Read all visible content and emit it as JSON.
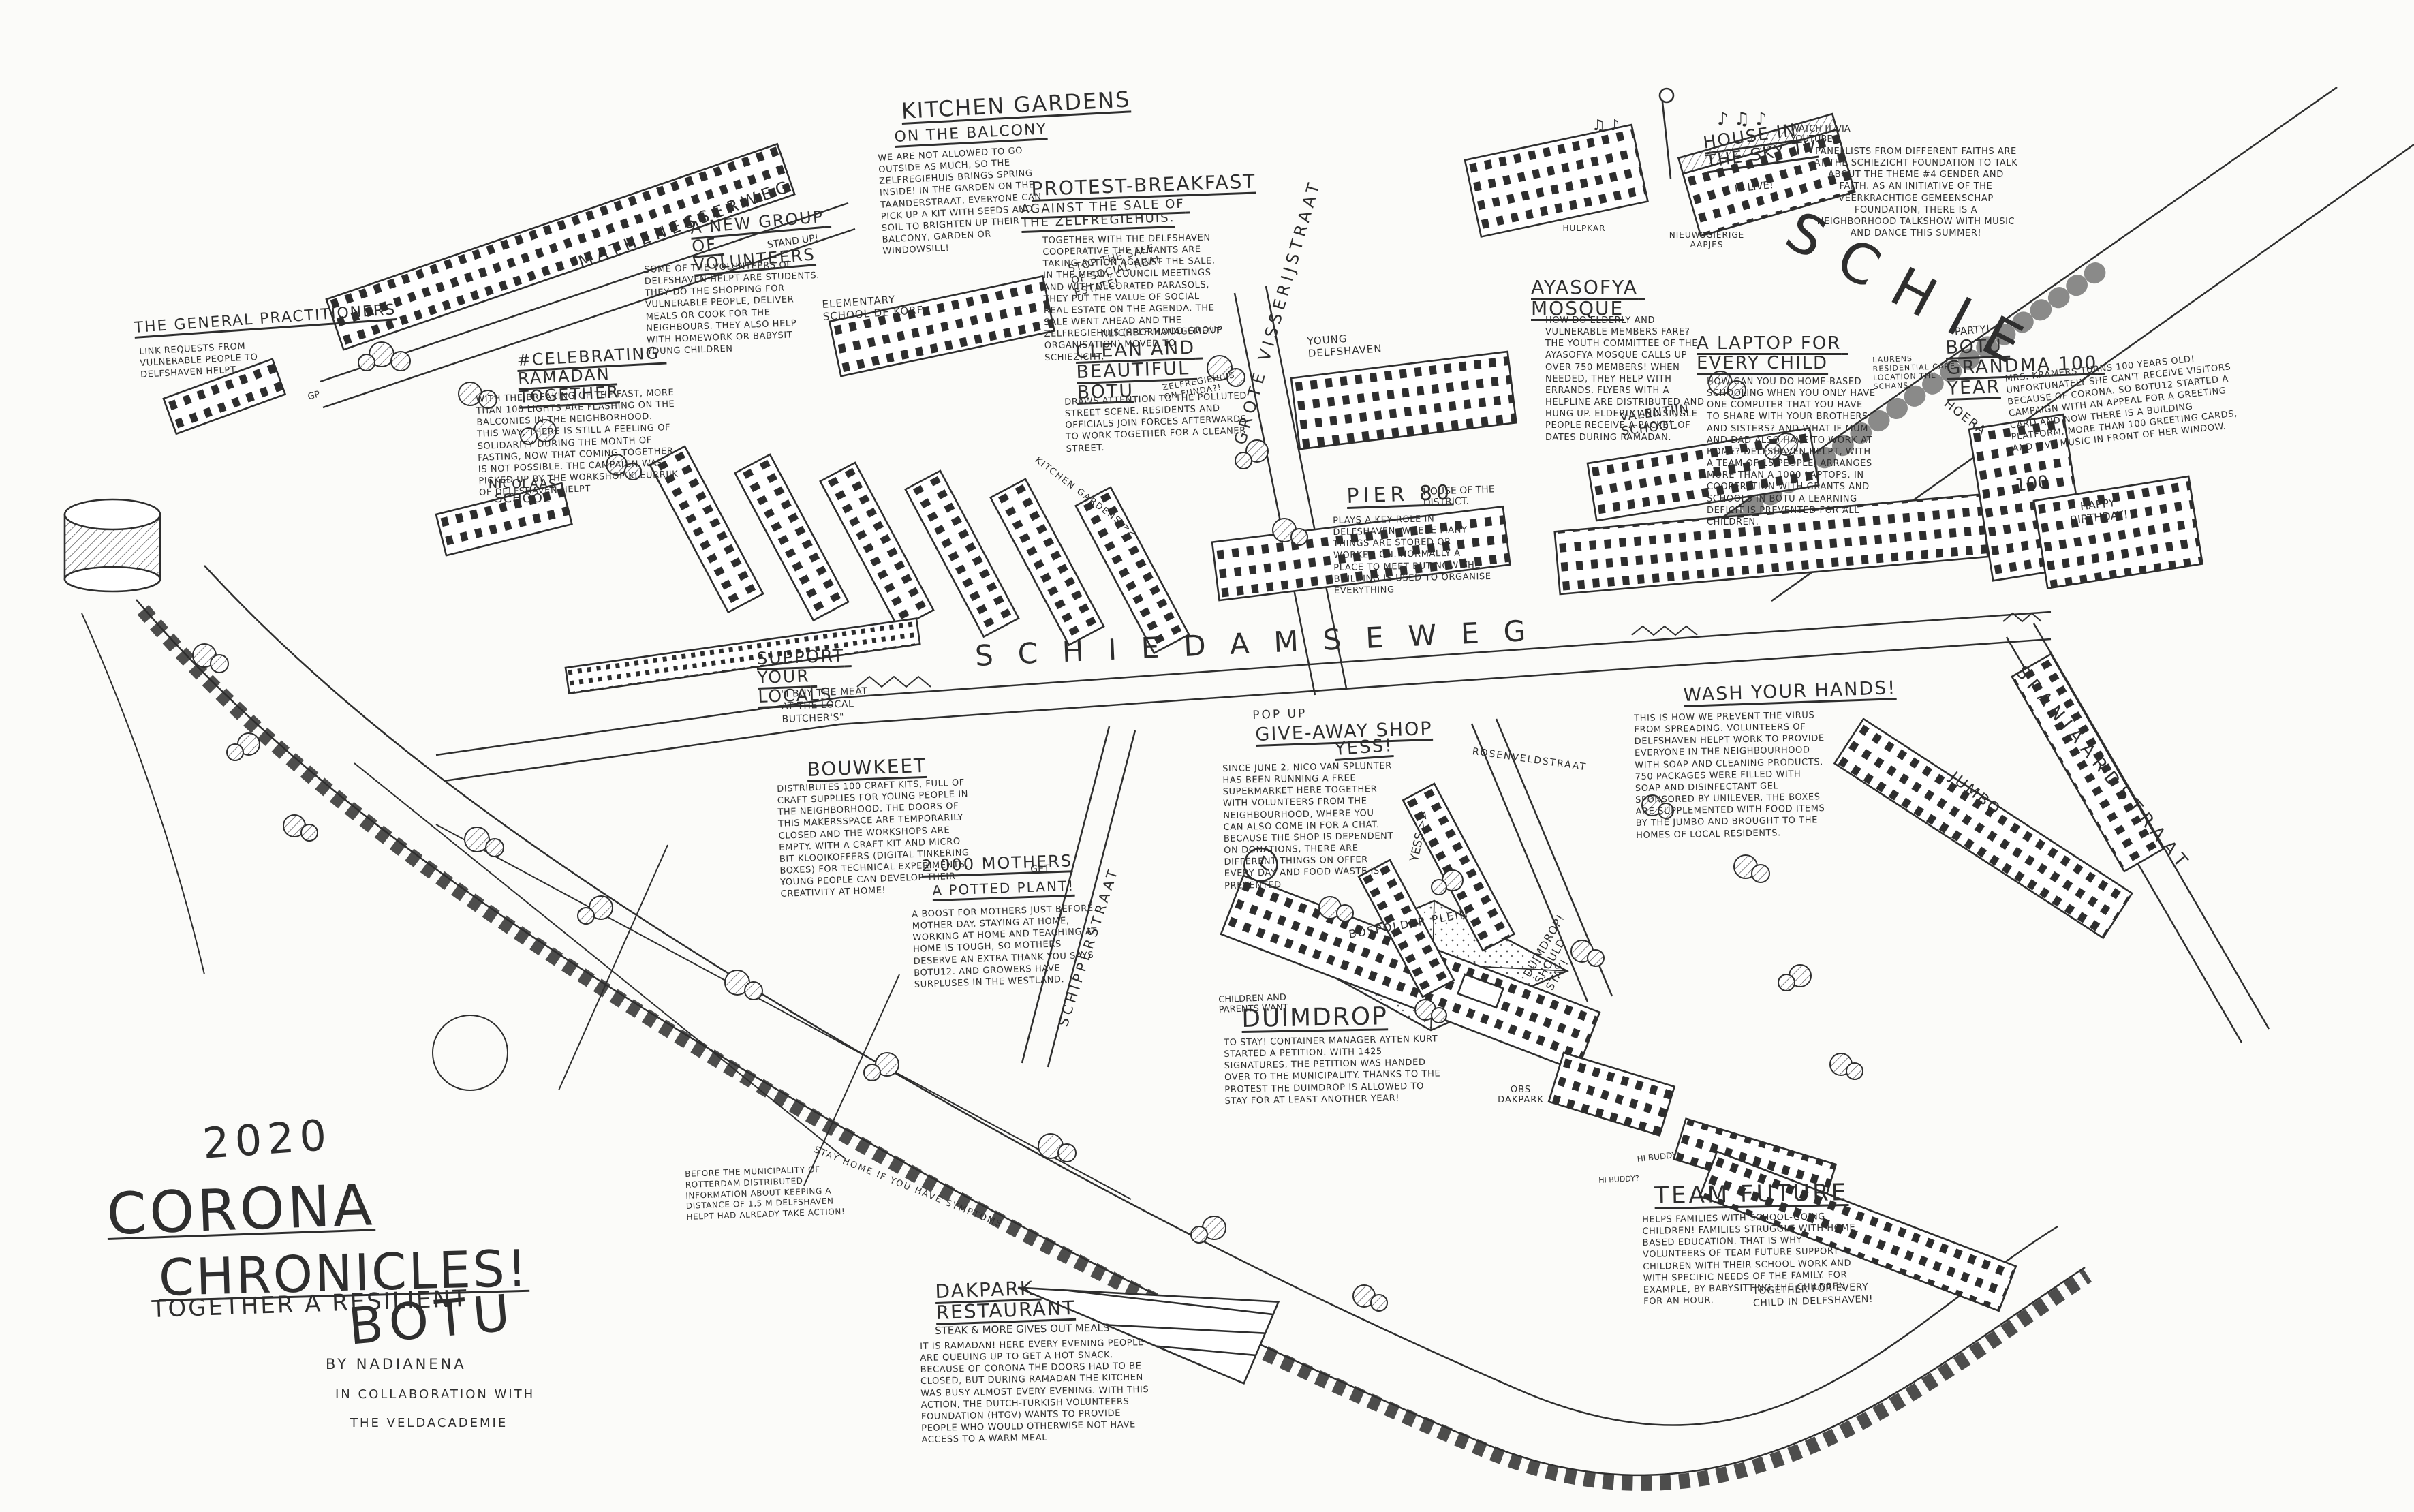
{
  "artwork": {
    "year": "2020",
    "title1": "CORONA",
    "title2": "CHRONICLES!",
    "subtitle": "TOGETHER A RESILIENT",
    "name": "BOTU",
    "credit_by": "BY NADIANENA",
    "credit_collab1": "IN COLLABORATION WITH",
    "credit_collab2": "THE VELDACADEMIE"
  },
  "streets": {
    "mathenesserweg": "MATHENESSERWEG",
    "schiedamseweg": "SCHIEDAMSEWEG",
    "grote_visserijstraat": "GROTE VISSERIJSTRAAT",
    "schipperstraat": "SCHIPPERSTRAAT",
    "spanjaardstraat": "SPANJAARDSTRAAT",
    "rosenveldstraat": "ROSENVELDSTRAAT",
    "schie": "SCHIE",
    "bospolderplein": "BOSPOLDER PLEIN"
  },
  "places": {
    "nicolaas_school": "NICOLAAS SCHOOL",
    "de_korf": "ELEMENTARY SCHOOL DE KORF",
    "valentijn_school": "VALENTIJN SCHOOL",
    "young_delfshaven": "YOUNG DELFSHAVEN",
    "laurens": "LAURENS RESIDENTIAL CARE LOCATION THE SCHANS.",
    "obs_dakpark": "OBS DAKPARK",
    "jumbo": "JUMBO",
    "gp": "GP",
    "nieuwsgierige_aapjes": "NIEUWSGIERIGE AAPJES",
    "hulpkar": "HULPKAR"
  },
  "signs": {
    "stop_sale": "STOP THE SALE OF SOCIAL REAL ESTATE!",
    "funda": "ZELFREGIEHUIS ON FUNDA?!",
    "kitchen_gardens_arrow": "KITCHEN GARDENS >>",
    "yess_arrow": "YESS >>",
    "duimdrop_should_stay": "DUIMDROP! SHOULD STAY!",
    "stay_home": "STAY HOME IF YOU HAVE SYMPTOMS",
    "happy_birthday": "HAPPY BIRTHDAY!",
    "hoera": "HOERA",
    "hundred": "100",
    "hi_buddy_1": "HI BUDDY!",
    "hi_buddy_2": "HI BUDDY?",
    "music_1": "♪ ♫  ♪",
    "music_2": "♫ ♪"
  },
  "stories": {
    "kitchen_gardens": {
      "title": "KITCHEN GARDENS",
      "subtitle": "ON THE BALCONY",
      "body": "WE ARE NOT ALLOWED TO GO OUTSIDE AS MUCH, SO THE ZELFREGIEHUIS BRINGS SPRING INSIDE! IN THE GARDEN ON THE TAANDERSTRAAT, EVERYONE CAN PICK UP A KIT WITH SEEDS AND SOIL TO BRIGHTEN UP THEIR BALCONY, GARDEN OR WINDOWSILL!"
    },
    "protest_breakfast": {
      "title": "PROTEST-BREAKFAST",
      "subtitle": "AGAINST THE SALE OF THE ZELFREGIEHUIS.",
      "body": "TOGETHER WITH THE DELFSHAVEN COOPERATIVE THE TENANTS ARE TAKING ACTION AGAINST THE SALE. IN THE MEDIA, COUNCIL MEETINGS AND WITH DECORATED PARASOLS, THEY PUT THE VALUE OF SOCIAL REAL ESTATE ON THE AGENDA. THE SALE WENT AHEAD AND THE ZELFREGIEHUIS (SELF MANAGEMENT ORGANISATION) MOVED TO SCHIEZICHT."
    },
    "new_volunteers": {
      "title": "A NEW GROUP OF VOLUNTEERS",
      "note": "STAND UP!",
      "body": "SOME OF THE VOLUNTEERS OF DELFSHAVEN HELPT ARE STUDENTS. THEY DO THE SHOPPING FOR VULNERABLE PEOPLE, DELIVER MEALS OR COOK FOR THE NEIGHBOURS. THEY ALSO HELP WITH HOMEWORK OR BABYSIT YOUNG CHILDREN"
    },
    "general_practitioners": {
      "title": "THE GENERAL PRACTITIONERS",
      "body": "LINK REQUESTS FROM VULNERABLE PEOPLE TO DELFSHAVEN HELPT"
    },
    "ramadan": {
      "title": "#CELEBRATING RAMADAN TOGETHER",
      "body": "WITH THE BREAKING OF THE FAST, MORE THAN 100 LIGHTS ARE FLASHING ON THE BALCONIES IN THE NEIGHBORHOOD. THIS WAY, THERE IS STILL A FEELING OF SOLIDARITY DURING THE MONTH OF FASTING, NOW THAT COMING TOGETHER IS NOT POSSIBLE. THE CAMPAIGN WAS PICKED UP BY THE WORKSHOP KLEURRIJK OF DELFSHAVEN HELPT"
    },
    "clean_beautiful": {
      "kicker": "NEIGHBORHOOD GROUP",
      "title": "CLEAN AND BEAUTIFUL BOTU",
      "body": "DRAWS ATTENTION TO THE POLLUTED STREET SCENE. RESIDENTS AND OFFICIALS JOIN FORCES AFTERWARDS TO WORK TOGETHER FOR A CLEANER STREET."
    },
    "ayasofya": {
      "title": "AYASOFYA MOSQUE",
      "body": "HOW DO ELDERLY AND VULNERABLE MEMBERS FARE? THE YOUTH COMMITTEE OF THE AYASOFYA MOSQUE CALLS UP OVER 750 MEMBERS! WHEN NEEDED, THEY HELP WITH ERRANDS. FLYERS WITH A HELPLINE ARE DISTRIBUTED AND HUNG UP. ELDERLY AND SINGLE PEOPLE RECEIVE A PACKET OF DATES DURING RAMADAN."
    },
    "laptop": {
      "title": "A LAPTOP FOR EVERY CHILD",
      "body": "HOW CAN YOU DO HOME-BASED SCHOOLING WHEN YOU ONLY HAVE ONE COMPUTER THAT YOU HAVE TO SHARE WITH YOUR BROTHERS AND SISTERS? AND WHAT IF MUM AND DAD ALSO HAVE TO WORK AT HOME? DELFSHAVEN HELPT, WITH A TEAM OF 15 PEOPLE, ARRANGES MORE THAN A 1000 LAPTOPS. IN COOPERATION WITH GRANTS AND SCHOOLS IN BOTU A LEARNING DEFICIT IS PREVENTED FOR ALL CHILDREN."
    },
    "sky_tv": {
      "title": "HOUSE IN THE SKY TV",
      "note": "IS LIVE!",
      "hint": "WATCH IT VIA YOUTUBE",
      "body": "PANELLISTS FROM DIFFERENT FAITHS ARE AT THE SCHIEZICHT FOUNDATION TO TALK ABOUT THE THEME #4 GENDER AND FAITH. AS AN INITIATIVE OF THE VEERKRACHTIGE GEMEENSCHAP FOUNDATION, THERE IS A NEIGHBORHOOD TALKSHOW WITH MUSIC AND DANCE THIS SUMMER!"
    },
    "grandma": {
      "kicker": "PARTY!",
      "title": "BOTU GRANDMA 100 YEAR",
      "body": "MRS. KRAMERS TURNS 100 YEARS OLD! UNFORTUNATELY SHE CAN'T RECEIVE VISITORS BECAUSE OF CORONA. SO BOTU12 STARTED A CAMPAIGN WITH AN APPEAL FOR A GREETING CARD AND NOW THERE IS A BUILDING PLATFORM, MORE THAN 100 GREETING CARDS, AND LIVE MUSIC IN FRONT OF HER WINDOW."
    },
    "pier80": {
      "title": "PIER 80",
      "subtitle": "HOUSE OF THE DISTRICT.",
      "body": "PLAYS A KEY ROLE IN DELFSHAVEN, WHERE MANY THINGS ARE STORED OR WORKED ON. NORMALLY A PLACE TO MEET BUT NOW THE BUILDING IS USED TO ORGANISE EVERYTHING"
    },
    "support_locals": {
      "title": "SUPPORT YOUR LOCALS",
      "quote": "\"I BUY THE MEAT AT THE LOCAL BUTCHER'S\""
    },
    "bouwkeet": {
      "title": "BOUWKEET",
      "body": "DISTRIBUTES 100 CRAFT KITS, FULL OF CRAFT SUPPLIES FOR YOUNG PEOPLE IN THE NEIGHBORHOOD. THE DOORS OF THIS MAKERSSPACE ARE TEMPORARILY CLOSED AND THE WORKSHOPS ARE EMPTY. WITH A CRAFT KIT AND MICRO BIT KLOOIKOFFERS (DIGITAL TINKERING BOXES) FOR TECHNICAL EXPERIMENTS, YOUNG PEOPLE CAN DEVELOP THEIR CREATIVITY AT HOME!"
    },
    "mothers": {
      "title": "2.000 MOTHERS",
      "note": "GET",
      "subtitle": "A POTTED PLANT!",
      "body": "A BOOST FOR MOTHERS JUST BEFORE MOTHER DAY. STAYING AT HOME, WORKING AT HOME AND TEACHING AT HOME IS TOUGH, SO MOTHERS DESERVE AN EXTRA THANK YOU SAYS BOTU12. AND GROWERS HAVE SURPLUSES IN THE WESTLAND."
    },
    "giveaway": {
      "kicker": "POP UP",
      "title": "GIVE-AWAY SHOP",
      "note": "YESS!",
      "body": "SINCE JUNE 2, NICO VAN SPLUNTER HAS BEEN RUNNING A FREE SUPERMARKET HERE TOGETHER WITH VOLUNTEERS FROM THE NEIGHBOURHOOD, WHERE YOU CAN ALSO COME IN FOR A CHAT. BECAUSE THE SHOP IS DEPENDENT ON DONATIONS, THERE ARE DIFFERENT THINGS ON OFFER EVERY DAY AND FOOD WASTE IS PREVENTED"
    },
    "wash_hands": {
      "title": "WASH YOUR HANDS!",
      "body": "THIS IS HOW WE PREVENT THE VIRUS FROM SPREADING. VOLUNTEERS OF DELFSHAVEN HELPT WORK TO PROVIDE EVERYONE IN THE NEIGHBOURHOOD WITH SOAP AND CLEANING PRODUCTS. 750 PACKAGES WERE FILLED WITH SOAP AND DISINFECTANT GEL SPONSORED BY UNILEVER. THE BOXES ARE SUPPLEMENTED WITH FOOD ITEMS BY THE JUMBO AND BROUGHT TO THE HOMES OF LOCAL RESIDENTS."
    },
    "duimdrop": {
      "kicker": "CHILDREN AND PARENTS WANT",
      "title": "DUIMDROP",
      "body": "TO STAY! CONTAINER MANAGER AYTEN KURT STARTED A PETITION. WITH 1425 SIGNATURES, THE PETITION WAS HANDED OVER TO THE MUNICIPALITY. THANKS TO THE PROTEST THE DUIMDROP IS ALLOWED TO STAY FOR AT LEAST ANOTHER YEAR!"
    },
    "team_future": {
      "title": "TEAM FUTURE",
      "body": "HELPS FAMILIES WITH SCHOOL-GOING CHILDREN! FAMILIES STRUGGLE WITH HOME BASED EDUCATION. THAT IS WHY VOLUNTEERS OF TEAM FUTURE SUPPORT CHILDREN WITH THEIR SCHOOL WORK AND WITH SPECIFIC NEEDS OF THE FAMILY. FOR EXAMPLE, BY BABYSITTING THE CHILDREN FOR AN HOUR.",
      "note": "TOGETHER FOR EVERY CHILD IN DELFSHAVEN!"
    },
    "dakpark_restaurant": {
      "title": "DAKPARK RESTAURANT",
      "subtitle": "STEAK & MORE  GIVES OUT MEALS",
      "body": "IT IS RAMADAN! HERE EVERY EVENING PEOPLE ARE QUEUING UP TO GET A HOT SNACK. BECAUSE OF CORONA THE DOORS HAD TO BE CLOSED, BUT DURING RAMADAN THE KITCHEN WAS BUSY ALMOST EVERY EVENING. WITH THIS ACTION, THE DUTCH-TURKISH VOLUNTEERS FOUNDATION (HTGV) WANTS TO PROVIDE PEOPLE WHO WOULD OTHERWISE NOT HAVE ACCESS TO A WARM MEAL"
    },
    "distance_note": {
      "body": "BEFORE THE MUNICIPALITY OF ROTTERDAM DISTRIBUTED INFORMATION ABOUT KEEPING A DISTANCE OF 1,5 M DELFSHAVEN HELPT HAD ALREADY TAKE ACTION!"
    }
  }
}
